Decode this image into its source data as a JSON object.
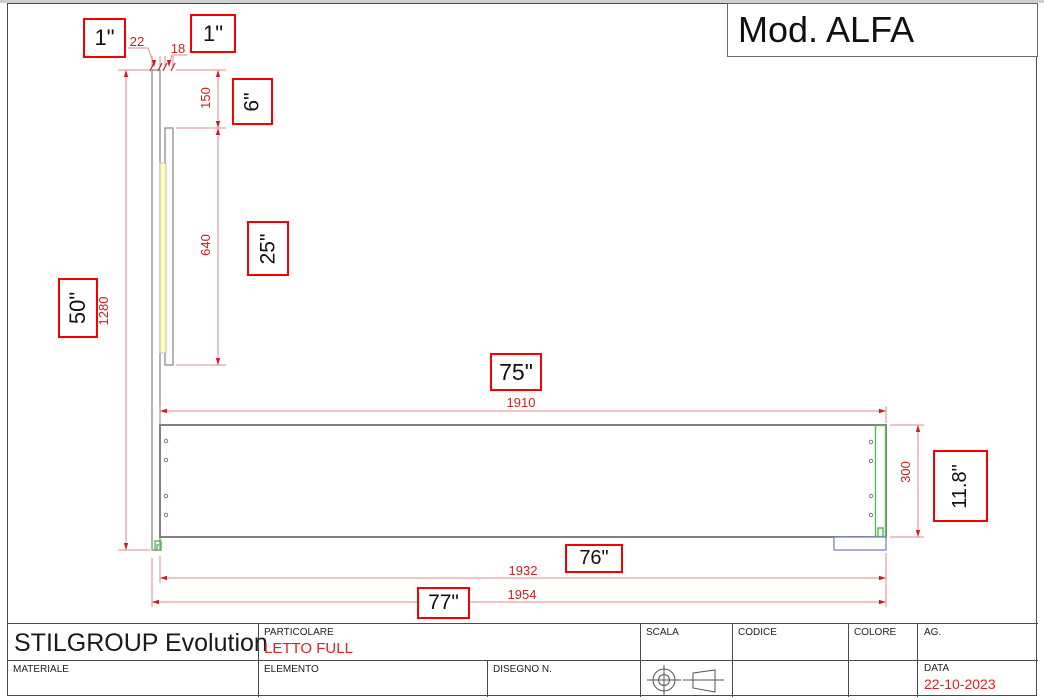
{
  "model": {
    "label": "Mod. ALFA"
  },
  "dimensions_mm": {
    "headboard_thickness": "22",
    "inner_panel_thickness": "18",
    "top_offset": "150",
    "inner_panel_length": "640",
    "headboard_height": "1280",
    "base_length": "1910",
    "base_height": "300",
    "overall_length_1932": "1932",
    "overall_length_1954": "1954"
  },
  "dimensions_in": {
    "in1a": "1\"",
    "in1b": "1\"",
    "in6": "6\"",
    "in25": "25\"",
    "in50": "50\"",
    "in75": "75\"",
    "in76": "76\"",
    "in77": "77\"",
    "in118": "11.8\""
  },
  "title_block": {
    "company": "STILGROUP Evolution",
    "particolare_label": "PARTICOLARE",
    "particolare_value": "LETTO FULL",
    "materiale_label": "MATERIALE",
    "elemento_label": "ELEMENTO",
    "disegno_label": "DISEGNO N.",
    "scala_label": "SCALA",
    "codice_label": "CODICE",
    "colore_label": "COLORE",
    "ag_label": "AG.",
    "data_label": "DATA",
    "data_value": "22-10-2023"
  },
  "colors": {
    "dim_line": "#d98c8c",
    "dim_text": "#cc2020",
    "box_border": "#f40000",
    "outline_gray": "#828282",
    "green": "#55bb55",
    "blue": "#7b82cc",
    "yellow": "#ffffb8"
  }
}
